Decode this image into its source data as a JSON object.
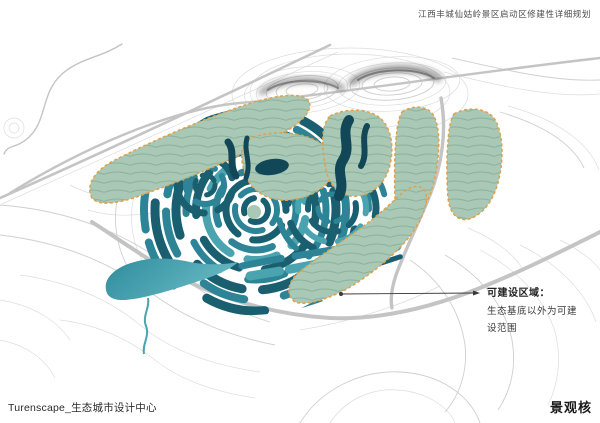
{
  "header": {
    "project_title": "江西丰城仙姑岭景区启动区修建性详细规划"
  },
  "callout": {
    "title": "可建设区域：",
    "line1": "生态基底以外为可建",
    "line2": "设范围"
  },
  "footer": {
    "studio_credit": "Turenscape_生态城市设计中心",
    "sheet_label": "景观核"
  },
  "colors": {
    "eco": "#a9c8b5",
    "eco-line": "#8bb29b",
    "border-orange": "#e2a048",
    "water-dark": "#1a5f70",
    "water-dark2": "#124757",
    "water-mid": "#2d8496",
    "water-light": "#4aa4b0",
    "lake-a": "#2e8c9d",
    "lake-b": "#66b8c2",
    "contour": "#cfcfcf",
    "road": "#c4c4c4",
    "ink": "#333333"
  }
}
